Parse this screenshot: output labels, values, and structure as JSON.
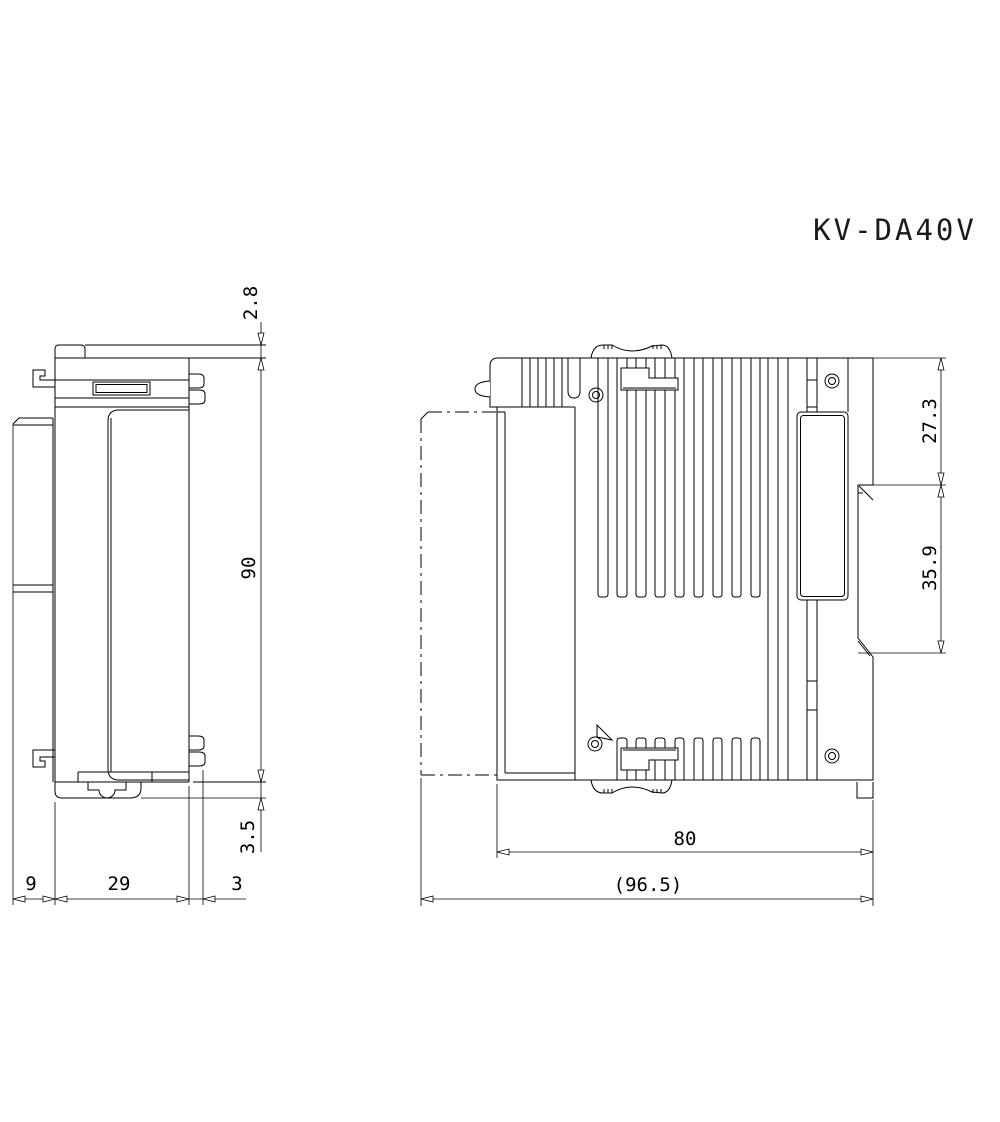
{
  "title": "KV-DA40V",
  "colors": {
    "background": "#ffffff",
    "line": "#000000"
  },
  "dimensions": {
    "front_view": {
      "top_tab_height": "2.8",
      "body_height": "90",
      "din_hook_offset": "3.5",
      "terminal_cover_width": "9",
      "body_width": "29",
      "side_tab_depth": "3"
    },
    "side_view": {
      "top_to_rail": "27.3",
      "rail_section": "35.9",
      "body_depth": "80",
      "overall_depth": "(96.5)"
    }
  }
}
